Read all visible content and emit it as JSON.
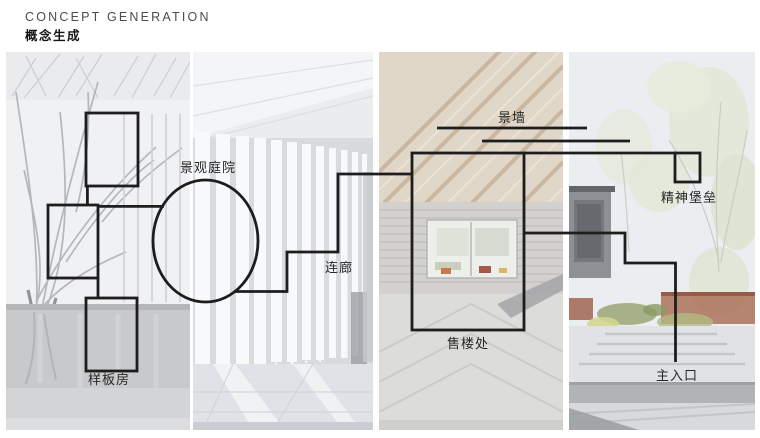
{
  "header": {
    "title_en": "CONCEPT GENERATION",
    "title_zh": "概念生成"
  },
  "diagram": {
    "line_color": "#1d1d1d",
    "labels": {
      "model_house": "样板房",
      "landscape_courtyard": "景观庭院",
      "corridor": "连廊",
      "sales_office": "售楼处",
      "landscape_wall": "景墙",
      "spirit_fortress": "精神堡垒",
      "main_entrance": "主入口"
    }
  },
  "photos": {
    "panel_1": "bare-trees-courtyard-photo",
    "panel_2": "light-colonnade-corridor-photo",
    "panel_3": "timber-ceiling-interior-photo",
    "panel_4": "entry-landscape-steps-photo"
  }
}
